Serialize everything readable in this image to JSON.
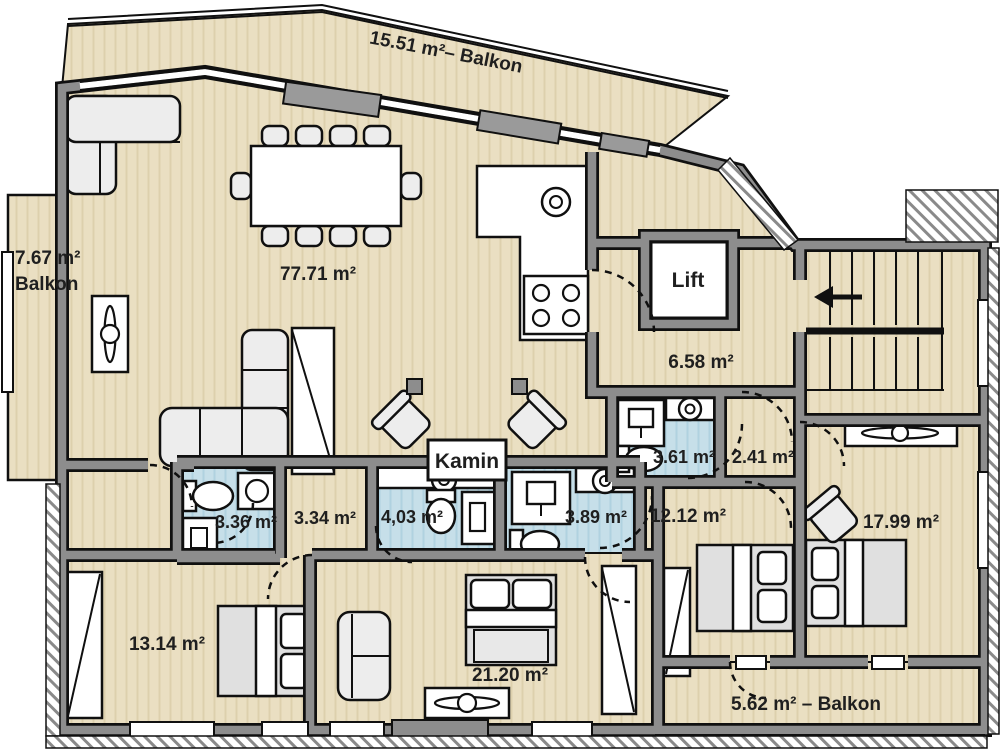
{
  "plan": {
    "type": "apartment-floor-plan",
    "language": "de",
    "colors": {
      "floor": "#eadfc2",
      "floor_stripe": "#ddd0ad",
      "bath": "#c6dfe9",
      "bath_stripe": "#b0d2e0",
      "wall_fill": "#8d8d8d",
      "wall_edge": "#101010",
      "furniture": "#ededed",
      "fixture_white": "#ffffff",
      "label_text": "#1f1f1f"
    },
    "rooms": {
      "balcony_top": {
        "label": "15.51 m²– Balkon"
      },
      "balcony_left": {
        "line1": "7.67 m²",
        "line2": "Balkon"
      },
      "balcony_bottom": {
        "label": "5.62 m² – Balkon"
      },
      "living": {
        "label": "77.71 m²"
      },
      "lift": {
        "label": "Lift"
      },
      "hall_main": {
        "label": "6.58 m²"
      },
      "fireplace": {
        "label": "Kamin"
      },
      "bath_a": {
        "label": "3.36 m²"
      },
      "hall_small": {
        "label": "3.34 m²"
      },
      "bath_b": {
        "label": "4,03 m²"
      },
      "bath_c": {
        "label": "3.89 m²"
      },
      "bath_d": {
        "label": "3.61 m²"
      },
      "hall_right": {
        "label": "2.41 m²"
      },
      "bed_center": {
        "label": "12.12 m²"
      },
      "bed_right": {
        "label": "17.99 m²"
      },
      "bed_left": {
        "label": "13.14 m²"
      },
      "bed_mid": {
        "label": "21.20 m²"
      }
    },
    "icons": {
      "entry_arrow": "left-arrow at staircase entry"
    }
  }
}
